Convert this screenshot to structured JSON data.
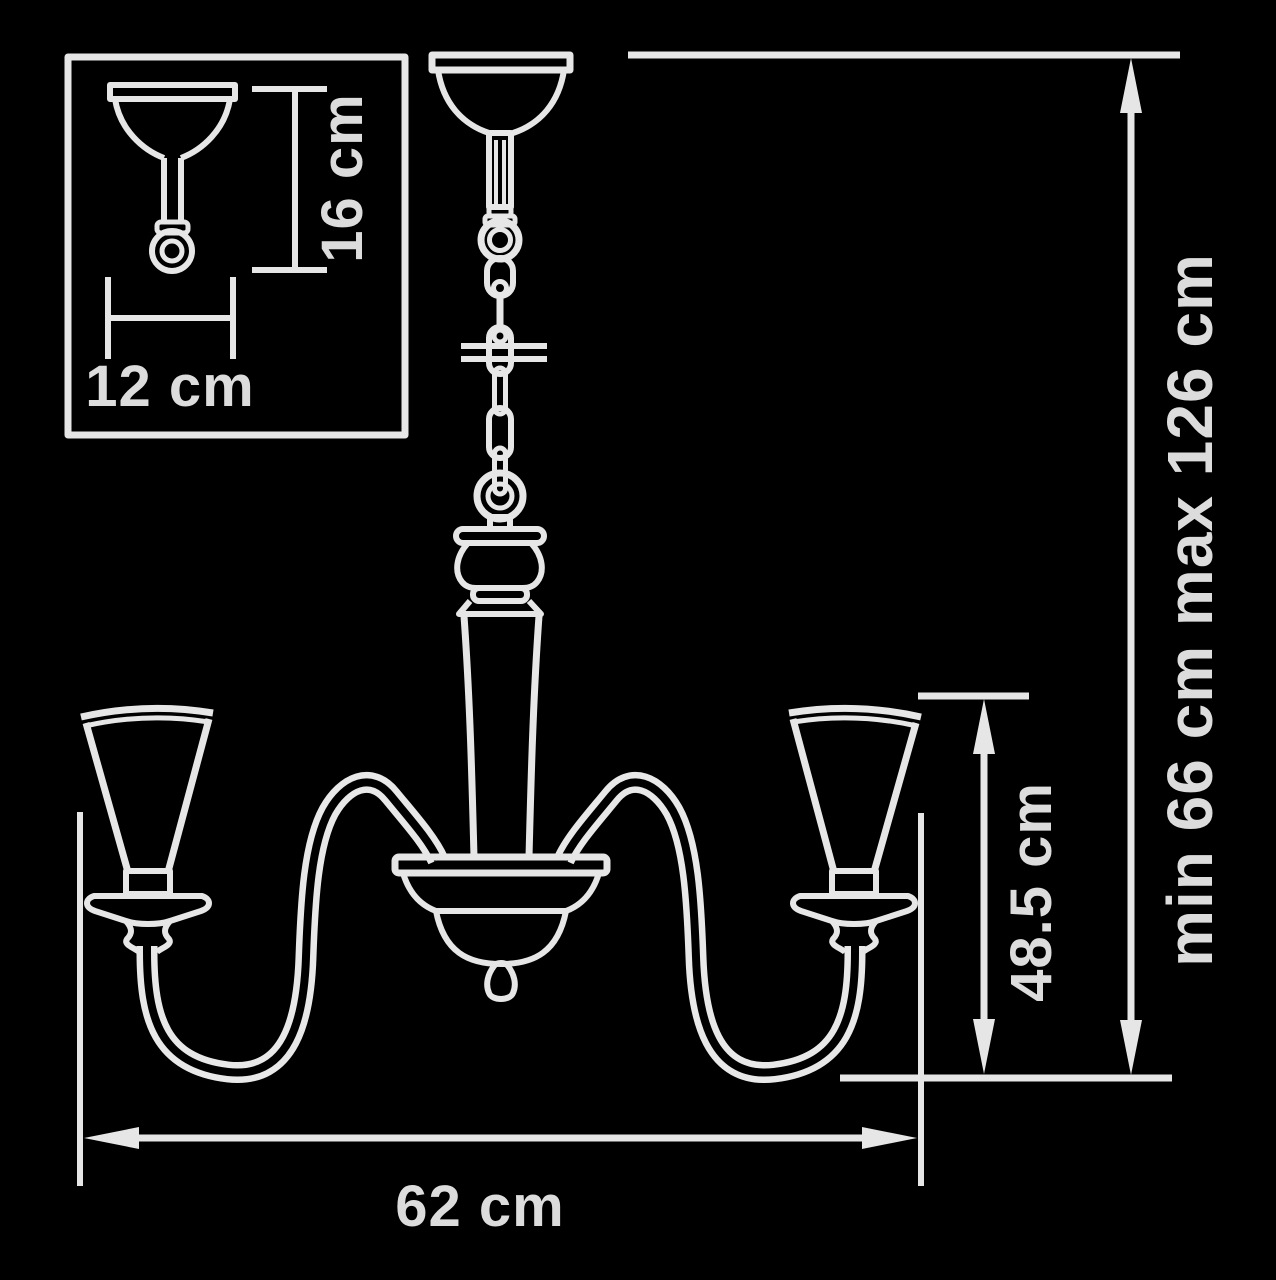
{
  "diagram": {
    "type": "chandelier-dimension-drawing",
    "colors": {
      "background": "#000000",
      "line": "#e6e6e6",
      "text": "#dcdcdc"
    },
    "labels": {
      "inset_mount_height": "16 cm",
      "inset_mount_width": "12 cm",
      "overall_height": "min 66 cm max 126 cm",
      "body_height": "48.5 cm",
      "body_width": "62 cm"
    },
    "values": {
      "inset_mount_height_cm": 16,
      "inset_mount_width_cm": 12,
      "overall_height_min_cm": 66,
      "overall_height_max_cm": 126,
      "body_height_cm": 48.5,
      "body_width_cm": 62
    }
  }
}
